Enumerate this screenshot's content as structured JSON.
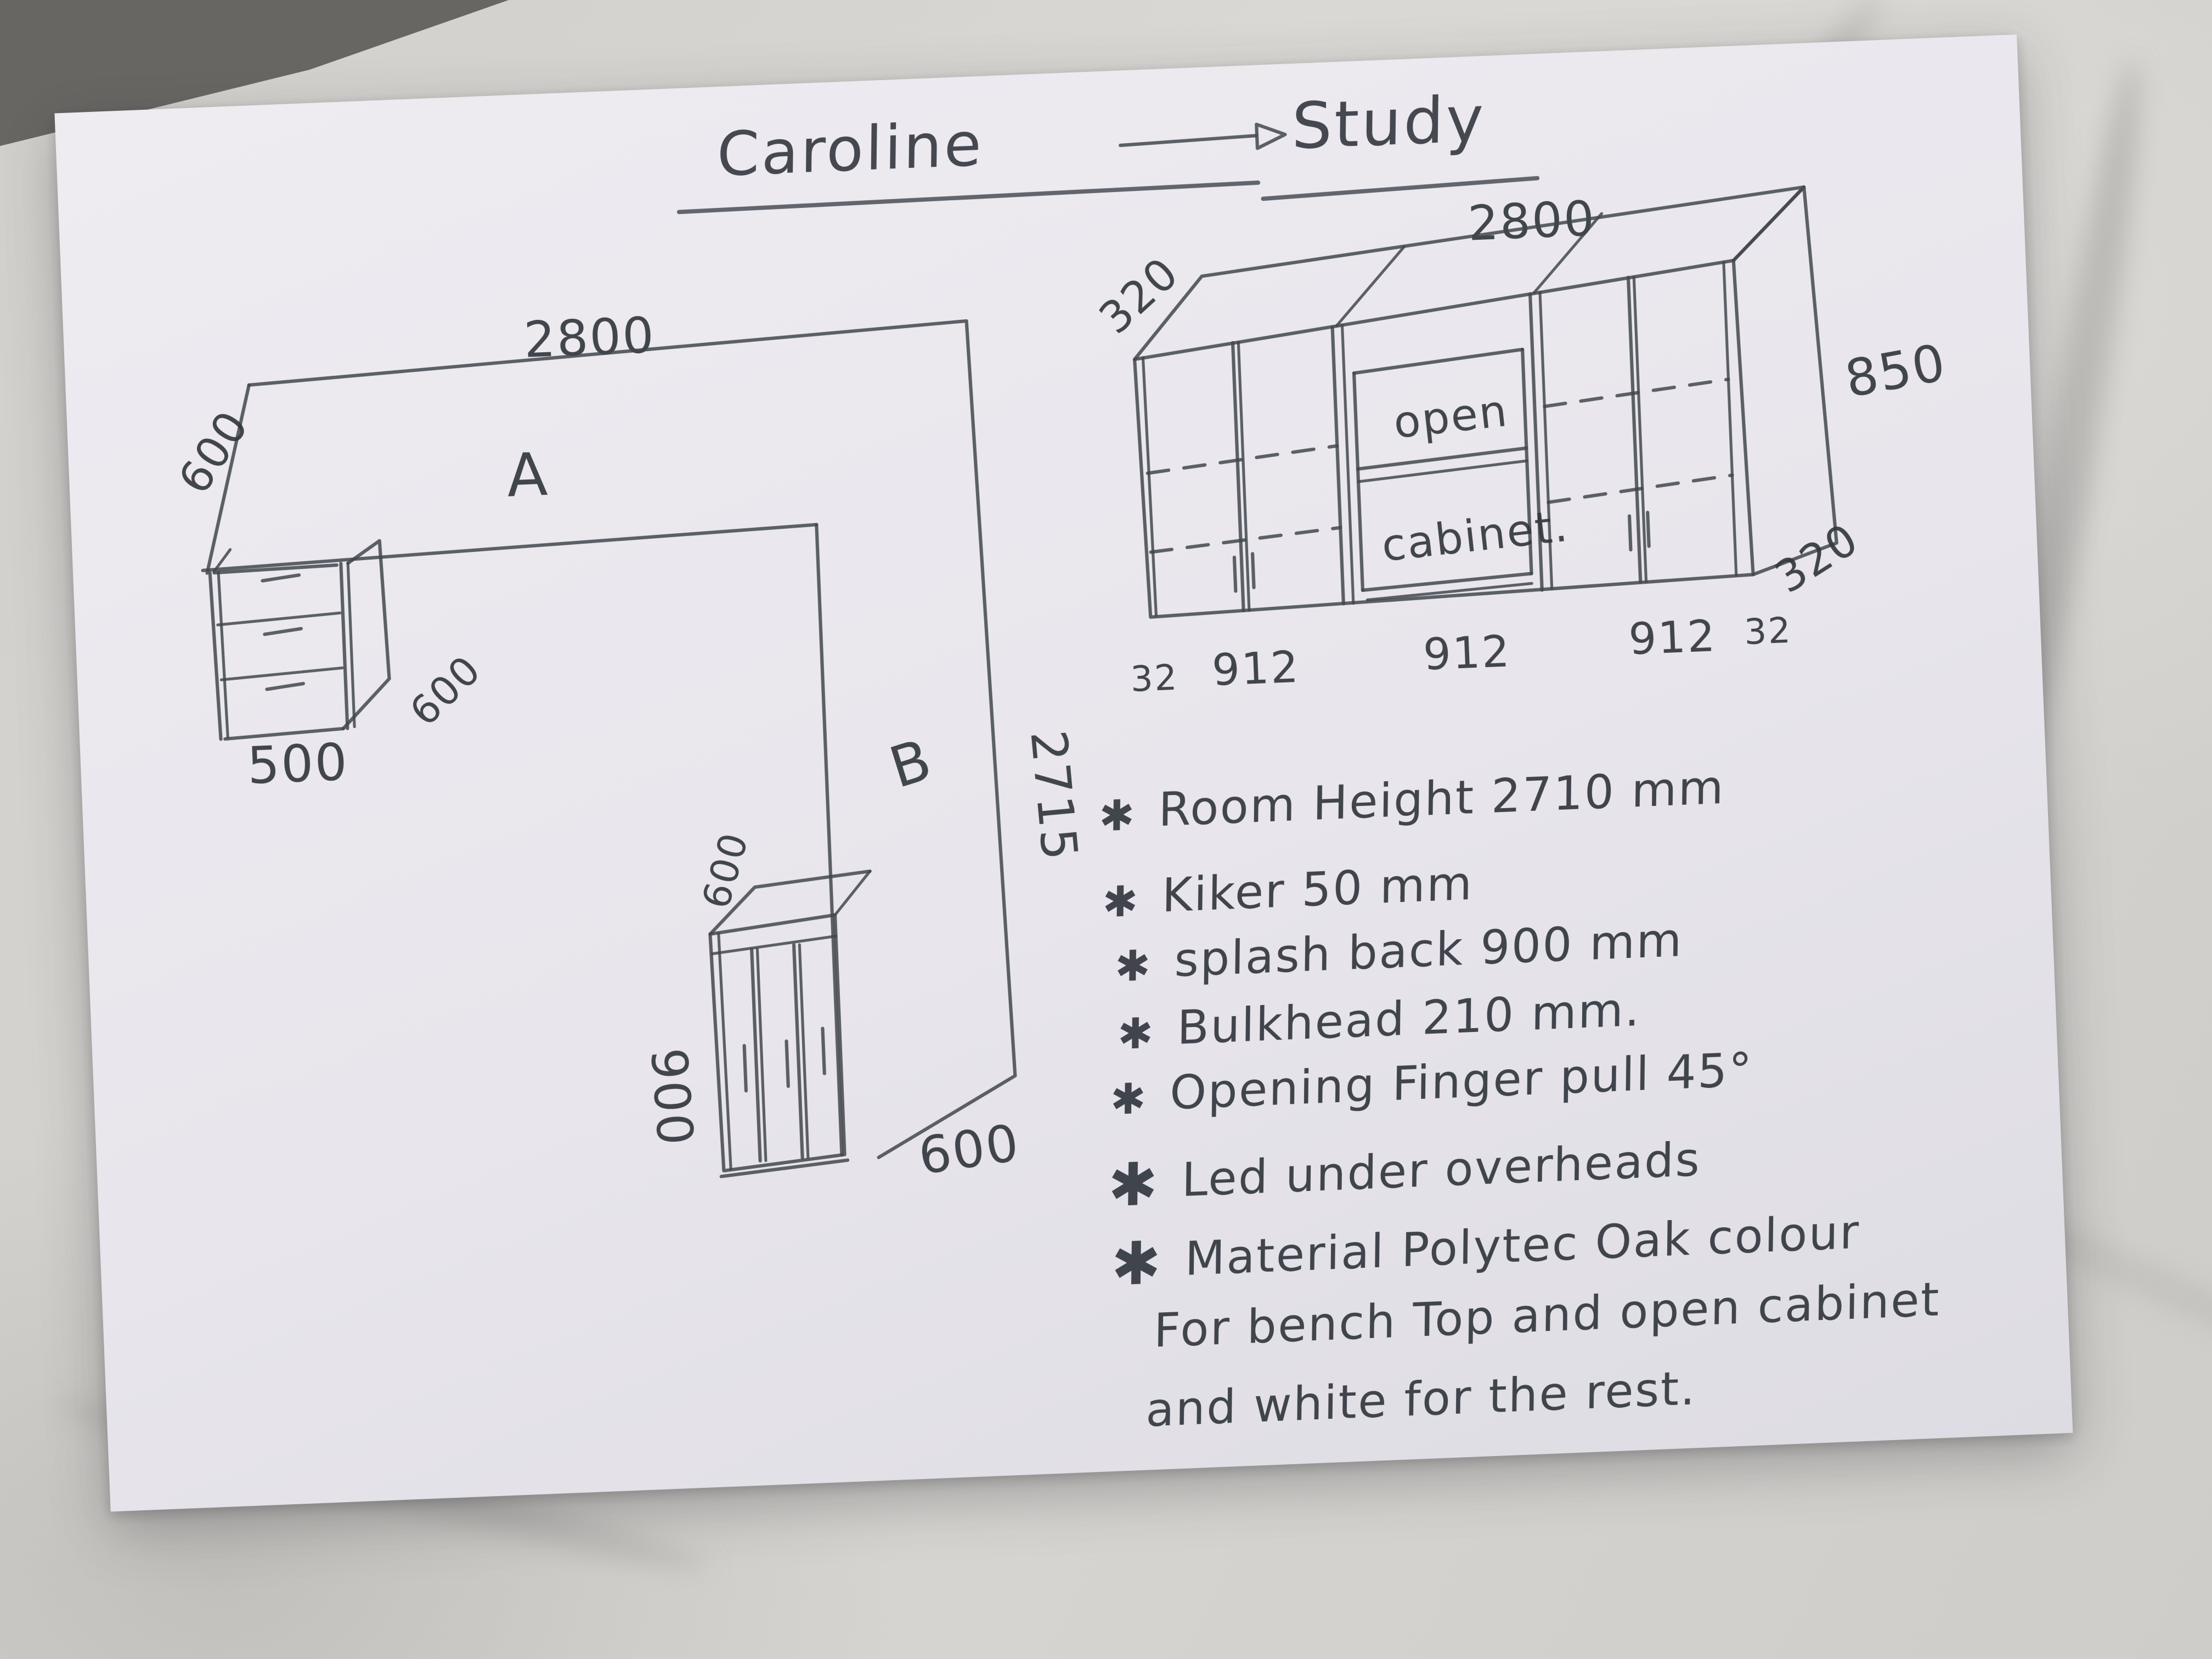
{
  "title": {
    "client": "Caroline",
    "room": "Study"
  },
  "elevation": {
    "width_label": "2800",
    "depth_top_label": "320",
    "height_label": "850",
    "depth_bottom_label": "320",
    "open_line1": "open",
    "open_line2": "cabinet.",
    "bottom_dims": [
      "32",
      "912",
      "912",
      "912",
      "32"
    ]
  },
  "plan": {
    "top_width": "2800",
    "left_depth": "600",
    "section_a": "A",
    "section_b": "B",
    "right_length": "2715",
    "drawer_width": "500",
    "drawer_depth": "600",
    "cabinet_depth": "600",
    "cabinet_width": "900",
    "bottom_depth": "600"
  },
  "notes": [
    {
      "bullet": "✱",
      "text": "Room Height 2710 mm"
    },
    {
      "bullet": "✱",
      "text": "Kiker 50 mm"
    },
    {
      "bullet": "✱",
      "text": "splash back 900 mm"
    },
    {
      "bullet": "✱",
      "text": "Bulkhead 210 mm."
    },
    {
      "bullet": "✱",
      "text": "Opening Finger pull 45°"
    },
    {
      "bullet": "✱",
      "text": "Led under overheads"
    },
    {
      "bullet": "✱",
      "text": "Material Polytec Oak colour"
    },
    {
      "bullet": "",
      "text": "For bench Top and open cabinet"
    },
    {
      "bullet": "",
      "text": "and white for the rest."
    }
  ]
}
